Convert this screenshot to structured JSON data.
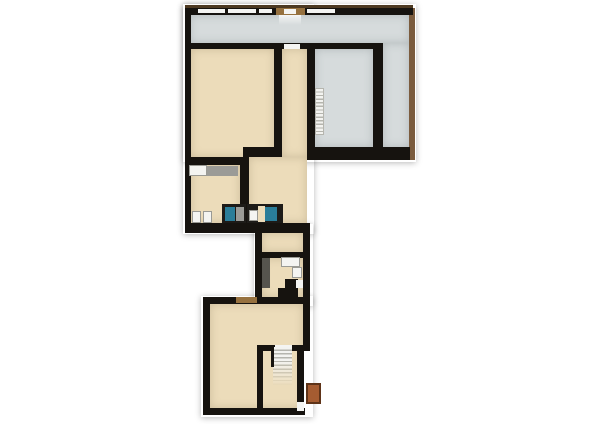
{
  "colors": {
    "background": "#ffffff",
    "wall": "#16130f",
    "floor_tan": "#ecdcba",
    "floor_gray": "#d6dbdc",
    "trim_brown": "#7b5c3e",
    "roof_edge": "#4e3a22",
    "window_white": "#f4f4f2",
    "door_brown": "#96713f",
    "fixture_white": "#f4f4f1",
    "fixture_border": "#9a9a94",
    "counter_gray": "#9b9b97",
    "sink_teal": "#2a7d99",
    "vanity_dark": "#1d1b18",
    "closet_dark": "#56544e",
    "stairs_white": "#f3f3f0",
    "stair_tread": "#b5b5ae",
    "chimney_brick": "#a55c31",
    "chimney_edge": "#5e3318"
  },
  "floorplan": {
    "kind": "architectural floor plan, top-down render, no text labels",
    "sections": [
      "upper-wing",
      "middle-connector",
      "lower-wing"
    ],
    "top_wall_window_count": 4,
    "staircases": [
      {
        "name": "upper-staircase",
        "treads": 13
      },
      {
        "name": "lower-staircase",
        "treads": 10
      }
    ],
    "fixtures": [
      "bathroom-counter",
      "toilet",
      "toilet",
      "teal-vanity-sink",
      "teal-vanity-sink",
      "washbasin",
      "closet",
      "winder-stair",
      "chimney"
    ]
  }
}
